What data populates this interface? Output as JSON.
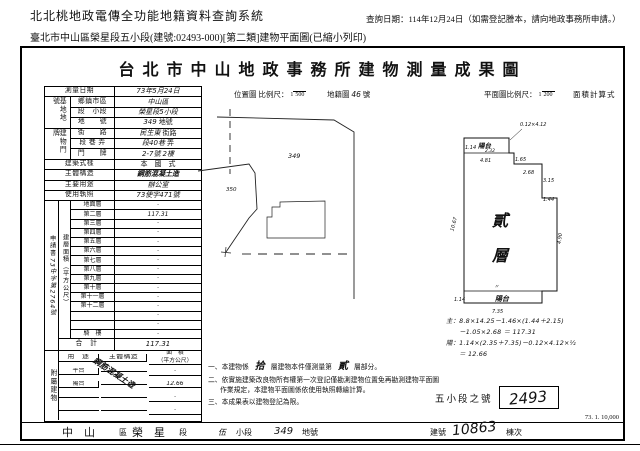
{
  "header": {
    "system_title": "北北桃地政電傳全功能地籍資料查詢系統",
    "query_date": "查詢日期：114年12月24日（如需登記謄本，請向地政事務所申請。）",
    "subtitle": "臺北市中山區榮星段五小段(建號:02493-000)[第二類]建物平面圖(已縮小列印)"
  },
  "doc": {
    "title": "台北市中山地政事務所建物測量成果圖",
    "scale": {
      "location_label": "位置圖 比例尺：",
      "location_num": "1",
      "location_den": "500",
      "cadastral_label": "地籍圖",
      "cadastral_no": "46",
      "cadastral_unit": "號",
      "plan_label": "平面圖比例尺：",
      "plan_num": "1",
      "plan_den": "200",
      "area_calc_label": "面積計算式"
    },
    "survey": {
      "label": "測量日期",
      "value": "73年5月24日"
    },
    "site": {
      "group": "基地地號",
      "rows": [
        {
          "label": "鄉鎮市區",
          "value": "中山區",
          "unit": ""
        },
        {
          "label": "段　小段",
          "value": "榮星段5小段",
          "unit": ""
        },
        {
          "label": "地　　號",
          "value": "349",
          "unit": "地號"
        }
      ]
    },
    "address": {
      "group": "建物門牌",
      "rows": [
        {
          "label": "街　　路",
          "value": "民生東",
          "unit": "街路"
        },
        {
          "label": "段 巷 弄",
          "value": "段40巷",
          "unit": "弄"
        },
        {
          "label": "門　　牌",
          "value": "2-7號",
          "unit": "2樓"
        }
      ]
    },
    "info_rows": [
      {
        "label": "建築式樣",
        "value": "本　國　式"
      },
      {
        "label": "主體構造",
        "value": "鋼筋混凝土造"
      },
      {
        "label": "主要用途",
        "value": "辦公室"
      },
      {
        "label": "使用執照",
        "value": "73使字471號"
      }
    ],
    "application": {
      "label": "申請書",
      "value": "73中字第2764號"
    },
    "floor_area": {
      "group": "建層面積（平方公尺）",
      "floors": [
        {
          "label": "地面層",
          "value": ""
        },
        {
          "label": "第二層",
          "value": "117.31"
        },
        {
          "label": "第三層",
          "value": ""
        },
        {
          "label": "第四層",
          "value": ""
        },
        {
          "label": "第五層",
          "value": ""
        },
        {
          "label": "第六層",
          "value": ""
        },
        {
          "label": "第七層",
          "value": ""
        },
        {
          "label": "第八層",
          "value": ""
        },
        {
          "label": "第九層",
          "value": ""
        },
        {
          "label": "第十層",
          "value": ""
        },
        {
          "label": "第十一層",
          "value": ""
        },
        {
          "label": "第十二層",
          "value": ""
        },
        {
          "label": "",
          "value": ""
        },
        {
          "label": "",
          "value": ""
        },
        {
          "label": "騎　樓",
          "value": ""
        }
      ],
      "total_label": "合　計",
      "total_value": "117.31"
    },
    "annex": {
      "group": "附屬建物",
      "headers": {
        "use": "用　途",
        "structure": "主體構造",
        "area": "面　積",
        "area_unit": "（平方公尺）"
      },
      "structure_note": "鋼筋混凝土造",
      "rows": [
        {
          "use": "平台",
          "area": ""
        },
        {
          "use": "陽台",
          "area": "12.66"
        },
        {
          "use": "",
          "area": ""
        },
        {
          "use": "",
          "area": ""
        }
      ],
      "total_label": "合　計",
      "total_value": "12.66"
    },
    "location_map": {
      "lot_main": "349",
      "lot_left": "350"
    },
    "plan": {
      "floor_char_1": "貳",
      "floor_char_2": "層",
      "balcony_top_label": "陽台",
      "balcony_bottom_label": "陽台",
      "dims": {
        "notch_width": "1.14",
        "notch_len": "2.32",
        "annot": "0.12×4.12",
        "top": "4.81",
        "step_a": "1.65",
        "step_b": "2.68",
        "step_c": "3.15",
        "step_d": "1.44",
        "left": "10.67",
        "right": "4.90",
        "ditto": "〃",
        "bottom_left": "1.14",
        "bottom": "7.35"
      },
      "calc_lines": [
        "主：8.8×14.25－1.46×(1.44＋2.15)",
        "　　－1.05×2.68 ＝ 117.31",
        "陽：1.14×(2.35＋7.35)－0.12×4.12×½",
        "　　＝ 12.66"
      ],
      "section_label": "五小段之號",
      "building_no": "2493"
    },
    "notes": {
      "n1_pre": "一、本建物係",
      "n1_floors": "拾",
      "n1_mid": "層建物本件僅測量第",
      "n1_part": "貳",
      "n1_post": "層部分。",
      "n2": "二、依實施建築改良物所有權第一次登記僅勘測建物位置免再勘測建物平面圖作業規定，本建物平面圖係依使用執照轉繪計算。",
      "n3": "三、本成果表以建物登記為限。"
    },
    "footer": {
      "district": "中　山",
      "district_unit": "區",
      "section": "榮　星",
      "section_unit": "段",
      "subsection": "伍",
      "subsection_unit": "小段",
      "lot": "349",
      "lot_unit": "地號",
      "building_label": "建號",
      "building_no": "10863",
      "unit_label": "棟次",
      "print_code": "73. 1. 10,000"
    }
  }
}
